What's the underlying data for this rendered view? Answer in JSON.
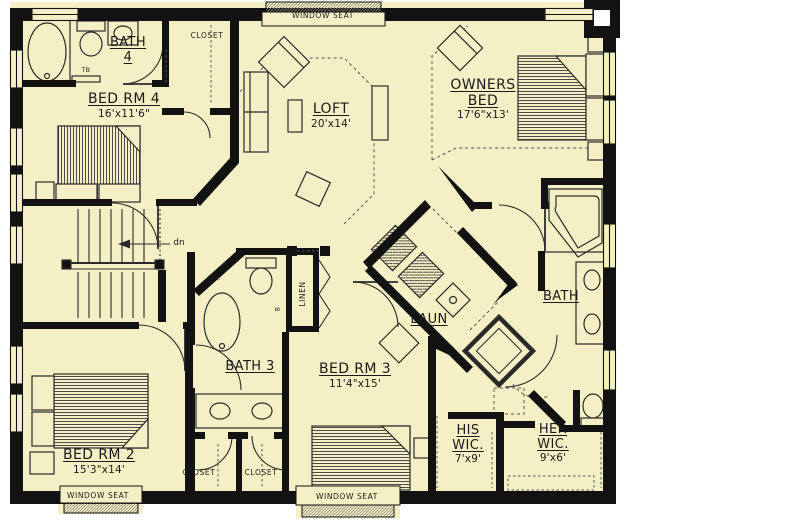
{
  "colors": {
    "floor": "#F5EFC5",
    "wall": "#121212",
    "paper": "#FFFFFF",
    "ink": "#1A1A1A"
  },
  "rooms": {
    "bath4": {
      "line1": "BATH",
      "line2": "4"
    },
    "bedrm4": {
      "line1": "BED RM 4",
      "dims": "16'x11'6\""
    },
    "loft": {
      "line1": "LOFT",
      "dims": "20'x14'"
    },
    "owners": {
      "line1": "OWNERS",
      "line2": "BED",
      "dims": "17'6\"x13'"
    },
    "laun": {
      "line1": "LAUN"
    },
    "bath_owner": {
      "line1": "BATH"
    },
    "bath3": {
      "line1": "BATH 3"
    },
    "bedrm3": {
      "line1": "BED RM 3",
      "dims": "11'4\"x15'"
    },
    "bedrm2": {
      "line1": "BED RM 2",
      "dims": "15'3\"x14'"
    },
    "his_wic": {
      "line1": "HIS",
      "line2": "WIC.",
      "dims": "7'x9'"
    },
    "her_wic": {
      "line1": "HER",
      "line2": "WIC.",
      "dims": "9'x6'"
    }
  },
  "labels": {
    "window_seat": "WINDOW SEAT",
    "closet": "CLOSET",
    "linen": "LINEN",
    "dn": "dn",
    "att": "ART.",
    "tb": "TB",
    "b": "B"
  }
}
